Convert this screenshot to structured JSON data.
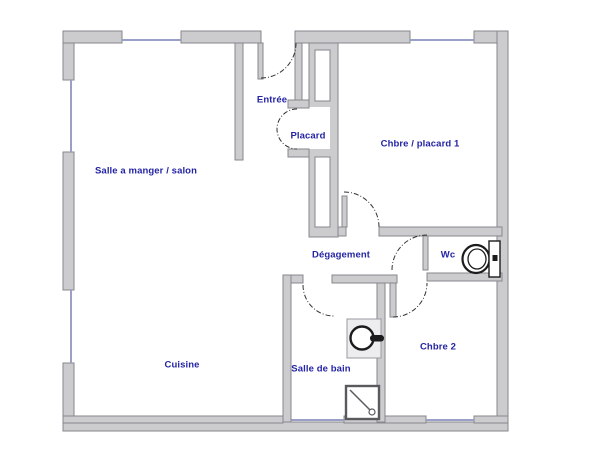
{
  "plan_title": "Apartment floor plan",
  "colors": {
    "background": "#ffffff",
    "wall_fill": "#cccccf",
    "wall_stroke": "#87878c",
    "window_line": "#9a9fc8",
    "label_text": "#2424a4",
    "door_arc": "#333333",
    "fixture_stroke": "#1c1c1c"
  },
  "rooms": [
    {
      "id": "salon",
      "label": "Salle a manger / salon"
    },
    {
      "id": "entree",
      "label": "Entrée"
    },
    {
      "id": "placard",
      "label": "Placard"
    },
    {
      "id": "chambre1",
      "label": "Chbre / placard 1"
    },
    {
      "id": "degagement",
      "label": "Dégagement"
    },
    {
      "id": "wc",
      "label": "Wc"
    },
    {
      "id": "cuisine",
      "label": "Cuisine"
    },
    {
      "id": "salle_de_bain",
      "label": "Salle de bain"
    },
    {
      "id": "chambre2",
      "label": "Chbre 2"
    }
  ],
  "fixtures": [
    {
      "name": "toilet",
      "room": "Wc"
    },
    {
      "name": "washbasin",
      "room": "Salle de bain"
    },
    {
      "name": "shower",
      "room": "Salle de bain"
    }
  ],
  "doors": [
    {
      "name": "entrance-door",
      "between": "outside / Entrée"
    },
    {
      "name": "placard-door",
      "between": "Entrée / Placard"
    },
    {
      "name": "chambre1-door",
      "between": "Dégagement / Chbre placard 1"
    },
    {
      "name": "wc-door",
      "between": "Dégagement / Wc"
    },
    {
      "name": "sdb-door",
      "between": "Dégagement / Salle de bain"
    },
    {
      "name": "chambre2-door",
      "between": "Dégagement / Chbre 2"
    }
  ]
}
